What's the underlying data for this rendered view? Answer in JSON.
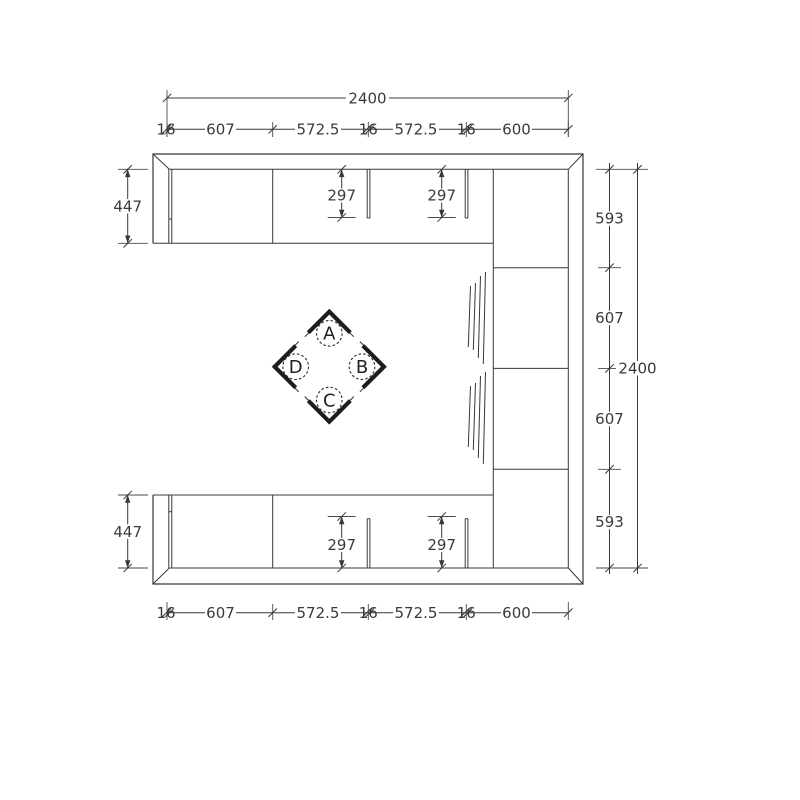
{
  "drawing": {
    "top": {
      "overall": "2400",
      "segments": [
        "16",
        "607",
        "572.5",
        "16",
        "572.5",
        "16",
        "600"
      ]
    },
    "bottom": {
      "segments": [
        "16",
        "607",
        "572.5",
        "16",
        "572.5",
        "16",
        "600"
      ]
    },
    "left": {
      "top_depth": "447",
      "bottom_depth": "447"
    },
    "right": {
      "sections": [
        "593",
        "607",
        "607",
        "593"
      ],
      "overall": "2400"
    },
    "partitions": {
      "top": [
        "297",
        "297"
      ],
      "bottom": [
        "297",
        "297"
      ]
    },
    "markers": {
      "top": "A",
      "right": "B",
      "bottom": "C",
      "left": "D"
    },
    "colors": {
      "line": "#383838",
      "marker": "#1d1d1d",
      "background": "#ffffff"
    }
  }
}
